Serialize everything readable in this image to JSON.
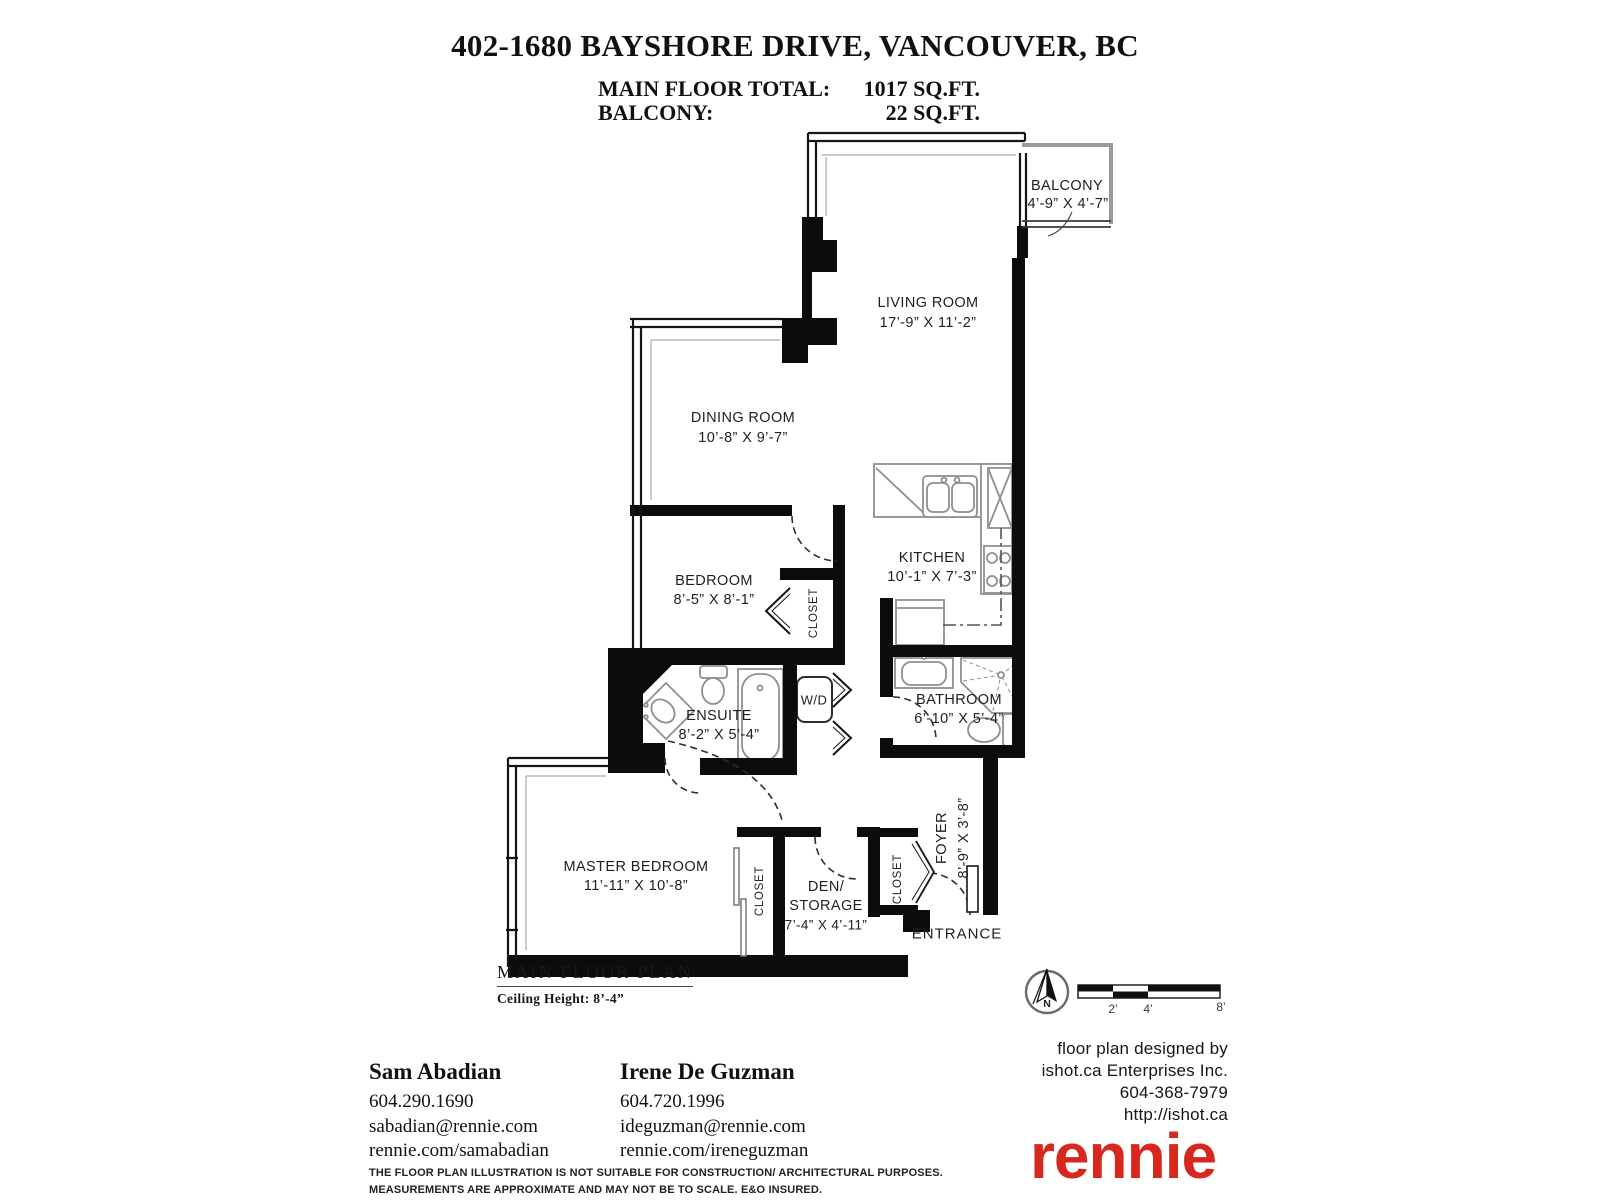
{
  "header": {
    "title": "402-1680 BAYSHORE DRIVE, VANCOUVER, BC",
    "summary": [
      {
        "label": "MAIN FLOOR TOTAL:",
        "value": "1017 SQ.FT."
      },
      {
        "label": "BALCONY:",
        "value": "22 SQ.FT."
      }
    ]
  },
  "rooms": {
    "balcony": {
      "name": "BALCONY",
      "dims": "4’-9” X 4’-7”"
    },
    "living": {
      "name": "LIVING ROOM",
      "dims": "17’-9” X 11’-2”"
    },
    "dining": {
      "name": "DINING ROOM",
      "dims": "10’-8” X 9’-7”"
    },
    "bedroom": {
      "name": "BEDROOM",
      "dims": "8’-5” X 8’-1”"
    },
    "kitchen": {
      "name": "KITCHEN",
      "dims": "10’-1” X 7’-3”"
    },
    "ensuite": {
      "name": "ENSUITE",
      "dims": "8’-2” X 5’-4”"
    },
    "bathroom": {
      "name": "BATHROOM",
      "dims": "6’-10” X 5’-4”"
    },
    "master": {
      "name": "MASTER BEDROOM",
      "dims": "11’-11” X 10’-8”"
    },
    "den": {
      "line1": "DEN/",
      "line2": "STORAGE",
      "dims": "7’-4” X 4’-11”"
    },
    "foyer": {
      "name": "FOYER",
      "dims": "8’-9” X 3’-8”"
    },
    "closet": "CLOSET",
    "wd": "W/D",
    "entrance": "ENTRANCE"
  },
  "plan_footer": {
    "heading": "MAIN FLOOR PLAN",
    "ceiling": "Ceiling Height: 8’-4”"
  },
  "agents": [
    {
      "name": "Sam Abadian",
      "phone": "604.290.1690",
      "email": "sabadian@rennie.com",
      "web": "rennie.com/samabadian"
    },
    {
      "name": "Irene De Guzman",
      "phone": "604.720.1996",
      "email": "ideguzman@rennie.com",
      "web": "rennie.com/ireneguzman"
    }
  ],
  "disclaimer": [
    "THE FLOOR PLAN ILLUSTRATION IS NOT SUITABLE FOR CONSTRUCTION/ ARCHITECTURAL PURPOSES.",
    "MEASUREMENTS ARE APPROXIMATE AND MAY NOT BE TO SCALE. E&O INSURED."
  ],
  "designer": {
    "line1": "floor plan designed by",
    "line2": "ishot.ca Enterprises Inc.",
    "line3": "604-368-7979",
    "line4": "http://ishot.ca"
  },
  "brand": {
    "logo": "rennie",
    "color": "#D7281F"
  },
  "compass": {
    "label": "N"
  },
  "scale_bar": {
    "ticks": [
      "2’",
      "4’",
      "8’"
    ]
  }
}
